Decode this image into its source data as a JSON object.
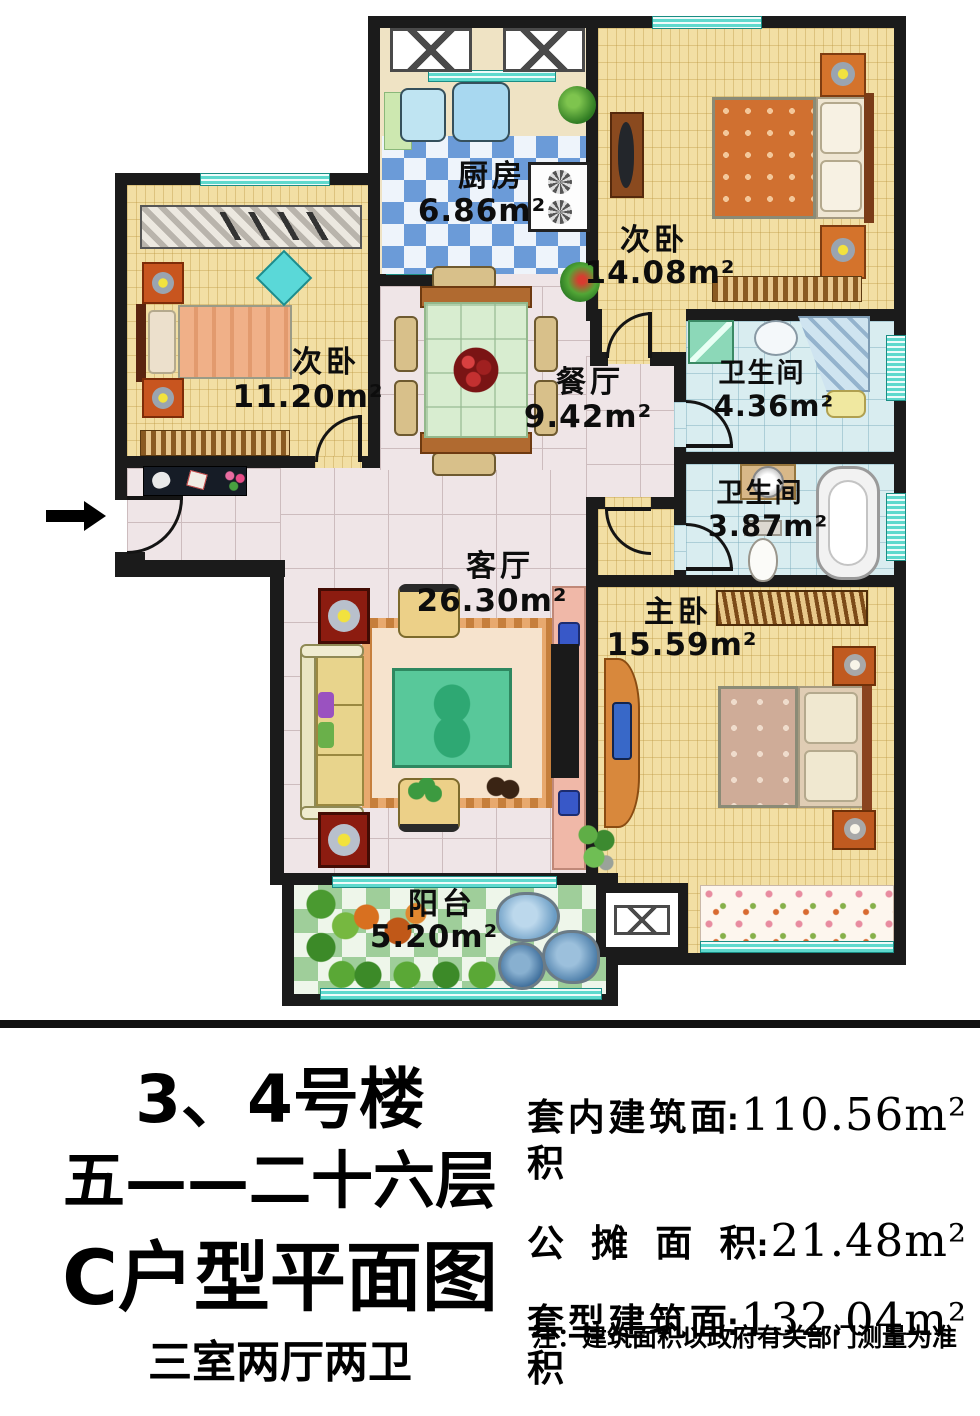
{
  "plan": {
    "rooms": {
      "kitchen": {
        "name": "厨房",
        "area": "6.86m²"
      },
      "bedroom2": {
        "name": "次卧",
        "area": "14.08m²"
      },
      "bedroom3": {
        "name": "次卧",
        "area": "11.20m²"
      },
      "dining": {
        "name": "餐厅",
        "area": "9.42m²"
      },
      "bath1": {
        "name": "卫生间",
        "area": "4.36m²"
      },
      "bath2": {
        "name": "卫生间",
        "area": "3.87m²"
      },
      "living": {
        "name": "客厅",
        "area": "26.30m²"
      },
      "master": {
        "name": "主卧",
        "area": "15.59m²"
      },
      "balcony": {
        "name": "阳台",
        "area": "5.20m²"
      }
    }
  },
  "info": {
    "building": "3、4号楼",
    "floors": "五——二十六层",
    "unit_title": "C户型平面图",
    "layout": "三室两厅两卫",
    "colon": ":",
    "stats": [
      {
        "label": "套内建筑面积",
        "value": "110.56m²"
      },
      {
        "label": "公摊面积",
        "value": "21.48m²"
      },
      {
        "label": "套型建筑面积",
        "value": "132.04m²"
      }
    ],
    "note": "注：建筑面积以政府有关部门测量为准"
  },
  "colors": {
    "wall": "#1b1b1b",
    "window": "#5ed9cd",
    "bedroom_floor": "#f2dfa4",
    "hall_floor": "#efe5e7",
    "kitchen_tile": "#6b9bd8",
    "balcony_tile": "#9fce9a",
    "bath_floor": "#d9edf0"
  }
}
